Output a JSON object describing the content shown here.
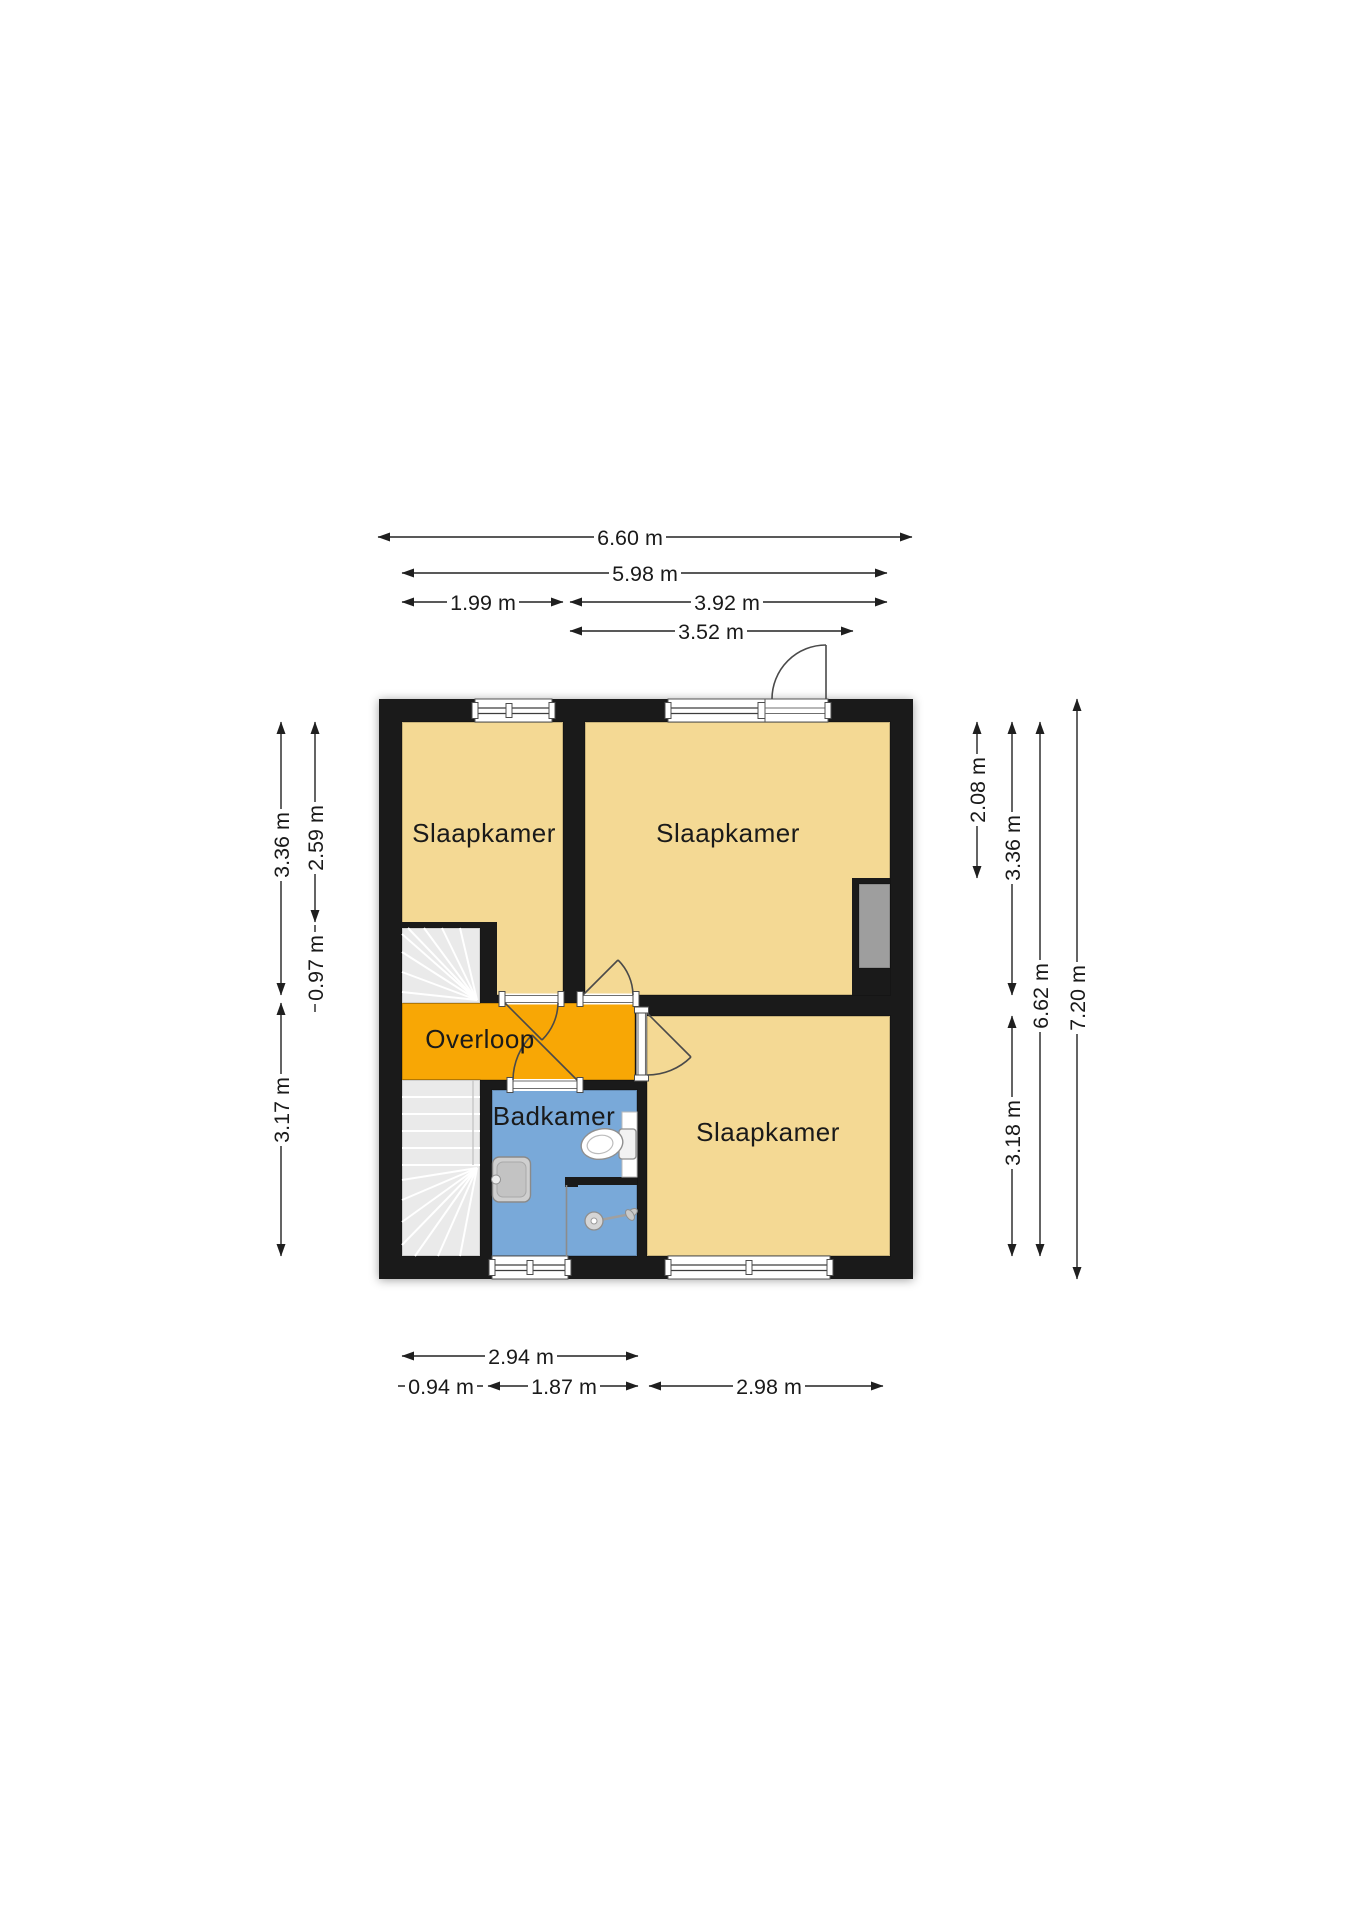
{
  "floorplan": {
    "rooms": {
      "bedroom_top_left": {
        "label": "Slaapkamer"
      },
      "bedroom_top_right": {
        "label": "Slaapkamer"
      },
      "bedroom_bottom": {
        "label": "Slaapkamer"
      },
      "landing": {
        "label": "Overloop"
      },
      "bathroom": {
        "label": "Badkamer"
      }
    },
    "dims": {
      "top": [
        {
          "label": "6.60 m"
        },
        {
          "label": "5.98 m"
        },
        {
          "label": "1.99 m"
        },
        {
          "label": "3.92 m"
        },
        {
          "label": "3.52 m"
        }
      ],
      "bottom": [
        {
          "label": "2.94 m"
        },
        {
          "label": "0.94 m"
        },
        {
          "label": "1.87 m"
        },
        {
          "label": "2.98 m"
        }
      ],
      "left": [
        {
          "label": "3.36 m"
        },
        {
          "label": "2.59 m"
        },
        {
          "label": "0.97 m"
        },
        {
          "label": "3.17 m"
        }
      ],
      "right": [
        {
          "label": "2.08 m"
        },
        {
          "label": "3.36 m"
        },
        {
          "label": "3.18 m"
        },
        {
          "label": "6.62 m"
        },
        {
          "label": "7.20 m"
        }
      ]
    },
    "colors": {
      "wall": "#1a1a1a",
      "room_fill": "#f4d994",
      "landing_fill": "#f8a705",
      "bathroom_fill": "#79a9d9",
      "stairs_fill": "#eaeaea",
      "niche_fill": "#9e9e9e",
      "background": "#ffffff"
    }
  }
}
